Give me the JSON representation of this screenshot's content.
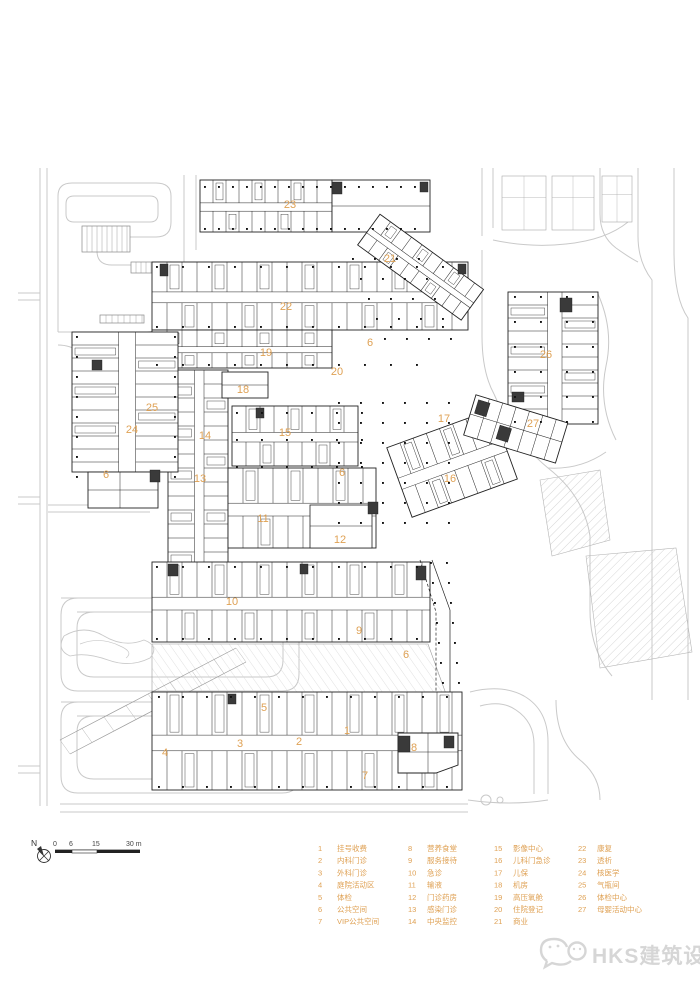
{
  "colors": {
    "accent": "#dfa154",
    "line": "#222222",
    "road": "#c9c9c9",
    "faint": "#a9a9a9",
    "watermark": "#d6d6d6"
  },
  "plan": {
    "labels": [
      {
        "n": "23",
        "x": 290,
        "y": 208
      },
      {
        "n": "21",
        "x": 390,
        "y": 262
      },
      {
        "n": "22",
        "x": 286,
        "y": 310
      },
      {
        "n": "6",
        "x": 370,
        "y": 346
      },
      {
        "n": "19",
        "x": 266,
        "y": 356
      },
      {
        "n": "26",
        "x": 546,
        "y": 358
      },
      {
        "n": "20",
        "x": 337,
        "y": 375
      },
      {
        "n": "18",
        "x": 243,
        "y": 393
      },
      {
        "n": "25",
        "x": 152,
        "y": 411
      },
      {
        "n": "17",
        "x": 444,
        "y": 422
      },
      {
        "n": "27",
        "x": 533,
        "y": 427
      },
      {
        "n": "24",
        "x": 132,
        "y": 433
      },
      {
        "n": "15",
        "x": 285,
        "y": 436
      },
      {
        "n": "14",
        "x": 205,
        "y": 439
      },
      {
        "n": "6",
        "x": 342,
        "y": 476
      },
      {
        "n": "6",
        "x": 106,
        "y": 478
      },
      {
        "n": "13",
        "x": 200,
        "y": 482
      },
      {
        "n": "16",
        "x": 450,
        "y": 482
      },
      {
        "n": "11",
        "x": 263,
        "y": 522
      },
      {
        "n": "12",
        "x": 340,
        "y": 543
      },
      {
        "n": "10",
        "x": 232,
        "y": 605
      },
      {
        "n": "9",
        "x": 359,
        "y": 634
      },
      {
        "n": "6",
        "x": 406,
        "y": 658
      },
      {
        "n": "5",
        "x": 264,
        "y": 711
      },
      {
        "n": "1",
        "x": 347,
        "y": 734
      },
      {
        "n": "2",
        "x": 299,
        "y": 745
      },
      {
        "n": "3",
        "x": 240,
        "y": 747
      },
      {
        "n": "8",
        "x": 414,
        "y": 751
      },
      {
        "n": "4",
        "x": 165,
        "y": 756
      },
      {
        "n": "7",
        "x": 365,
        "y": 779
      }
    ]
  },
  "legend": {
    "items": [
      {
        "n": "1",
        "label": "挂号收费"
      },
      {
        "n": "2",
        "label": "内科门诊"
      },
      {
        "n": "3",
        "label": "外科门诊"
      },
      {
        "n": "4",
        "label": "庭院活动区"
      },
      {
        "n": "5",
        "label": "体检"
      },
      {
        "n": "6",
        "label": "公共空间"
      },
      {
        "n": "7",
        "label": "VIP公共空间"
      },
      {
        "n": "8",
        "label": "营养食堂"
      },
      {
        "n": "9",
        "label": "服务接待"
      },
      {
        "n": "10",
        "label": "急诊"
      },
      {
        "n": "11",
        "label": "输液"
      },
      {
        "n": "12",
        "label": "门诊药房"
      },
      {
        "n": "13",
        "label": "感染门诊"
      },
      {
        "n": "14",
        "label": "中央监控"
      },
      {
        "n": "15",
        "label": "影像中心"
      },
      {
        "n": "16",
        "label": "儿科门急诊"
      },
      {
        "n": "17",
        "label": "儿保"
      },
      {
        "n": "18",
        "label": "机房"
      },
      {
        "n": "19",
        "label": "高压氧舱"
      },
      {
        "n": "20",
        "label": "住院登记"
      },
      {
        "n": "21",
        "label": "商业"
      },
      {
        "n": "22",
        "label": "康复"
      },
      {
        "n": "23",
        "label": "透析"
      },
      {
        "n": "24",
        "label": "核医学"
      },
      {
        "n": "25",
        "label": "气瓶间"
      },
      {
        "n": "26",
        "label": "体检中心"
      },
      {
        "n": "27",
        "label": "母婴活动中心"
      }
    ]
  },
  "scalebar": {
    "labels": [
      "0",
      "6",
      "15",
      "30 m"
    ]
  },
  "north": {
    "label": "N"
  },
  "footer": {
    "brand": "HKS建筑设计"
  }
}
